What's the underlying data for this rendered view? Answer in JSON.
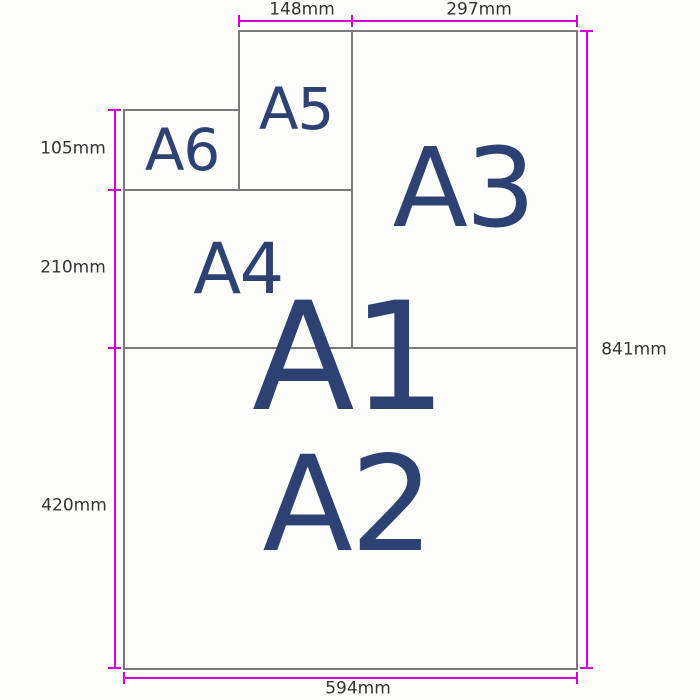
{
  "labels": {
    "a1": "A1",
    "a2": "A2",
    "a3": "A3",
    "a4": "A4",
    "a5": "A5",
    "a6": "A6"
  },
  "dimensions": {
    "top_left": "148mm",
    "top_right": "297mm",
    "left_upper": "105mm",
    "left_middle": "210mm",
    "left_lower": "420mm",
    "right": "841mm",
    "bottom": "594mm"
  },
  "colors": {
    "dimension_line": "#d400d4",
    "sheet_border": "#7a7a7a",
    "size_label": "#2d4172",
    "dimension_text": "#333333",
    "background": "#fdfdfc"
  }
}
